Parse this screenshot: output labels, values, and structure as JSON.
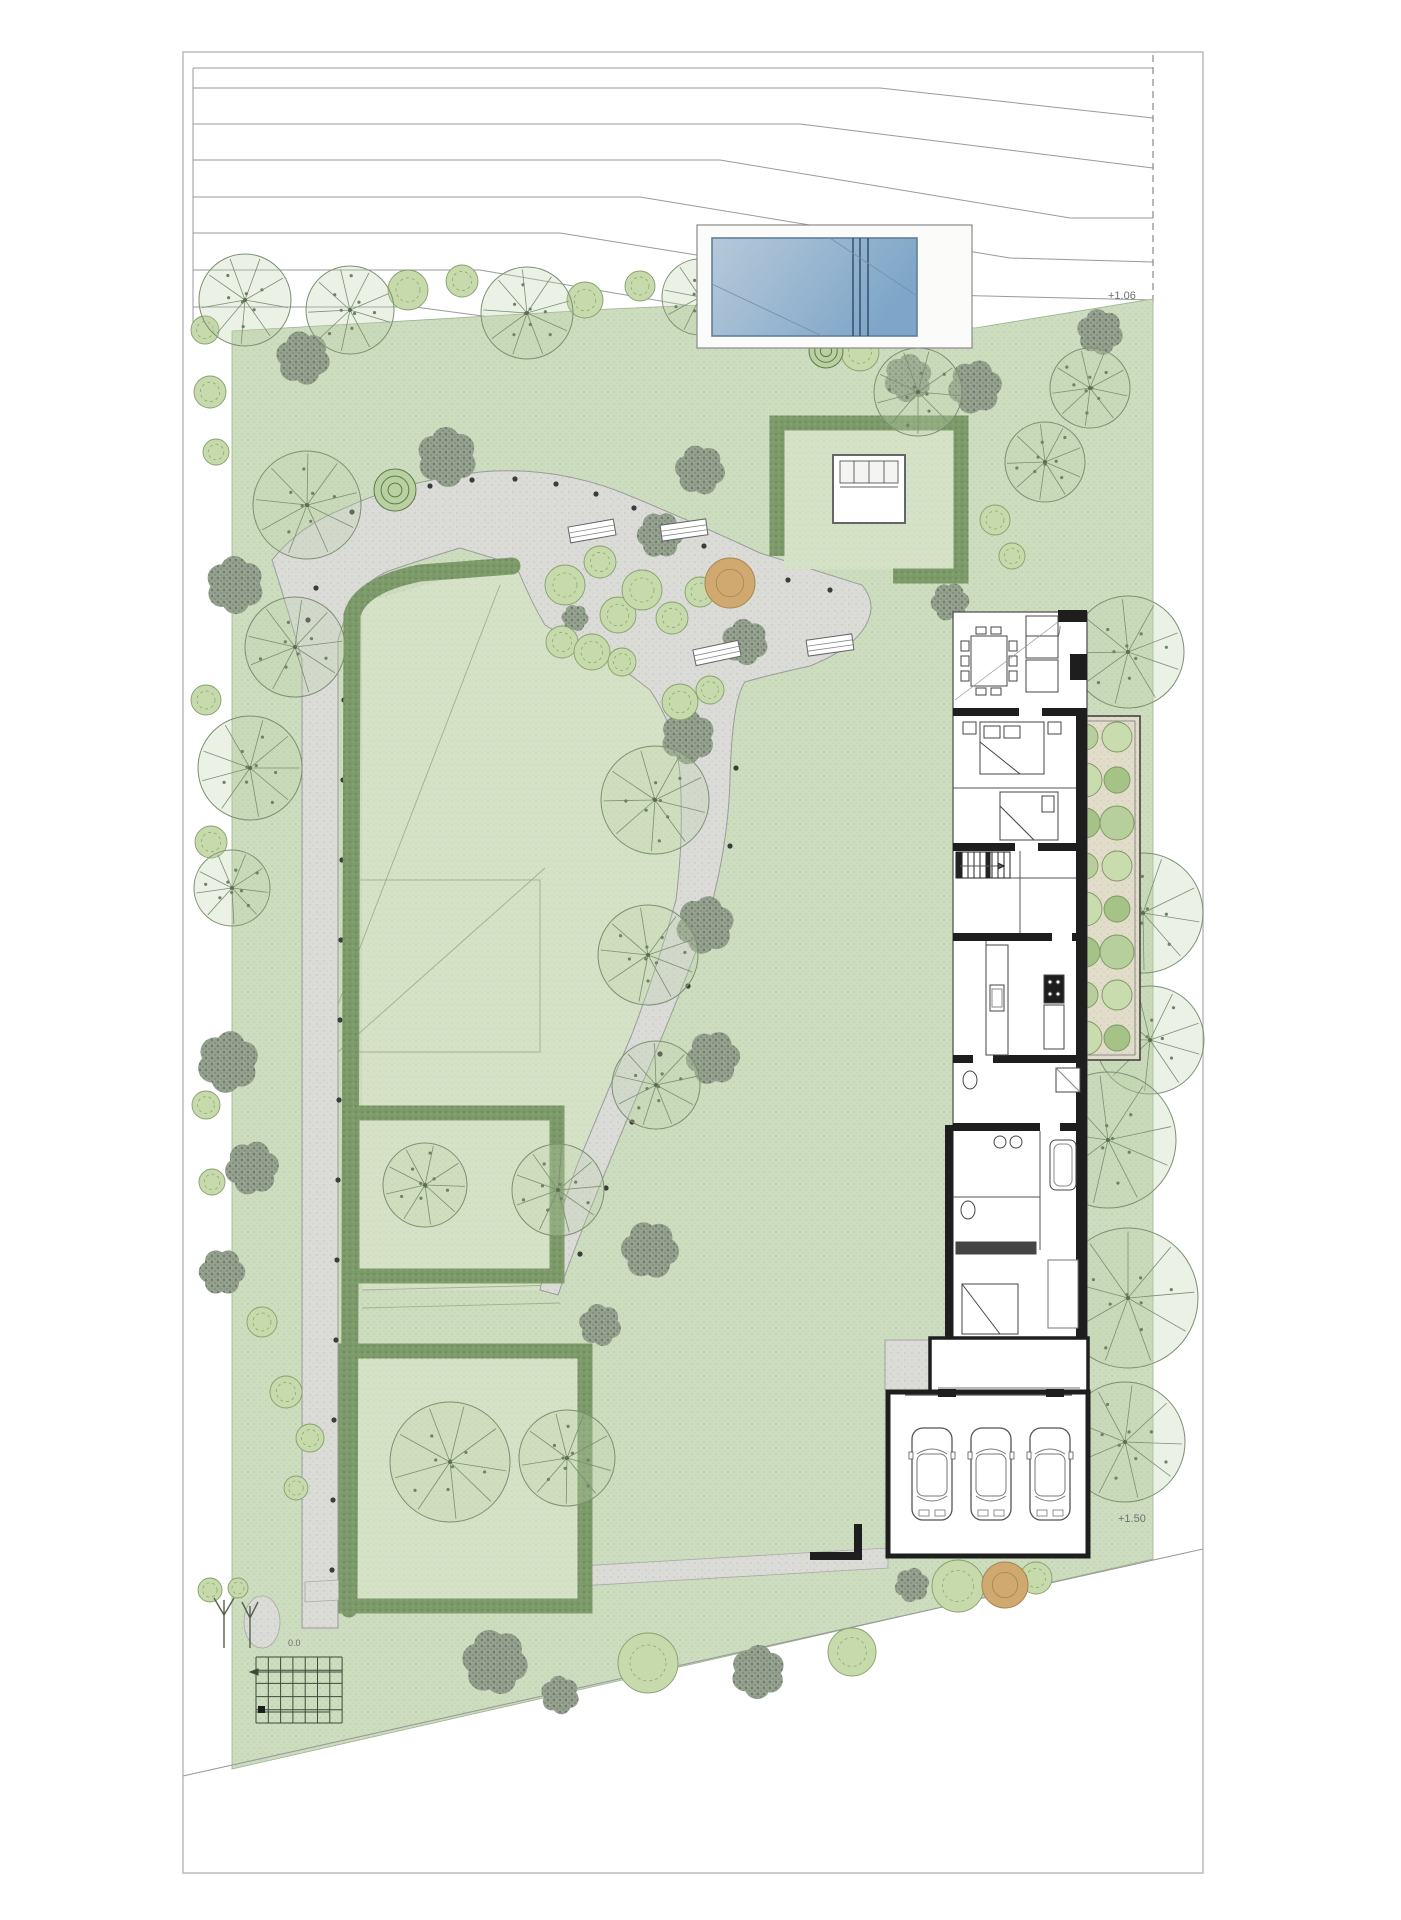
{
  "meta": {
    "drawing_type": "landscape-site-plan",
    "features": [
      "contour lines",
      "swimming pool",
      "garden pavilion",
      "hedge parterres",
      "winding gravel path",
      "residence floor plan",
      "planted strip",
      "garage with cars",
      "trellis grid"
    ]
  },
  "labels": {
    "elevation_upper": "+1.06",
    "elevation_lower": "+1.50",
    "path_end": "0.0"
  },
  "palette": {
    "paper": "#ffffff",
    "sheet_border": "#b7b7b7",
    "contour": "#9a9a9a",
    "green": "#cdddc0",
    "green_dot": "#bccdaa",
    "lawn": "#d6e2c7",
    "hedge": "#7d9a6a",
    "hedge_dark": "#4e6a3f",
    "path": "#dbdcd8",
    "path_edge": "#9b9b9b",
    "wall": "#1e1e1e",
    "line": "#555555",
    "pool_light": "#b6c9da",
    "pool_dark": "#7fa6c8",
    "pool_edge": "#5f7f9d",
    "gravel": "#e2ddca",
    "tan": "#cfa96f",
    "stipple": "#8f988b",
    "stipple_dark": "#6c7a66",
    "shrub_light": "#c6daab",
    "shrub_edge": "#87a06d",
    "text": "#6f6f6f"
  },
  "garage": {
    "car_count": 3,
    "cars_x": [
      912,
      971,
      1030
    ],
    "cars_y": 1428
  },
  "planter": {
    "x": 1066,
    "y": 716,
    "w": 74,
    "h": 344,
    "rows": 8,
    "cols_x": [
      1085,
      1117
    ]
  },
  "benches": [
    [
      592,
      531,
      -10
    ],
    [
      684,
      530,
      -8
    ],
    [
      717,
      653,
      -12
    ],
    [
      830,
      645,
      -8
    ]
  ],
  "trees": {
    "spoke": [
      [
        245,
        300,
        46
      ],
      [
        350,
        310,
        44
      ],
      [
        527,
        313,
        46
      ],
      [
        700,
        297,
        38
      ],
      [
        873,
        303,
        38
      ],
      [
        918,
        392,
        44
      ],
      [
        1090,
        388,
        40
      ],
      [
        1128,
        652,
        56
      ],
      [
        307,
        505,
        54
      ],
      [
        295,
        647,
        50
      ],
      [
        250,
        768,
        52
      ],
      [
        232,
        888,
        38
      ],
      [
        655,
        800,
        54
      ],
      [
        648,
        955,
        50
      ],
      [
        656,
        1085,
        44
      ],
      [
        558,
        1190,
        46
      ],
      [
        425,
        1185,
        42
      ],
      [
        1143,
        913,
        60
      ],
      [
        1150,
        1040,
        54
      ],
      [
        1108,
        1140,
        68
      ],
      [
        1128,
        1298,
        70
      ],
      [
        1125,
        1442,
        60
      ],
      [
        450,
        1462,
        60
      ],
      [
        567,
        1458,
        48
      ],
      [
        1045,
        462,
        40
      ]
    ],
    "stipple": [
      [
        303,
        358,
        28
      ],
      [
        447,
        457,
        31
      ],
      [
        908,
        378,
        25
      ],
      [
        975,
        387,
        28
      ],
      [
        660,
        535,
        24
      ],
      [
        700,
        470,
        26
      ],
      [
        745,
        642,
        24
      ],
      [
        688,
        737,
        28
      ],
      [
        705,
        925,
        30
      ],
      [
        713,
        1058,
        28
      ],
      [
        650,
        1250,
        30
      ],
      [
        600,
        1325,
        22
      ],
      [
        235,
        585,
        30
      ],
      [
        228,
        1062,
        32
      ],
      [
        252,
        1168,
        28
      ],
      [
        222,
        1272,
        24
      ],
      [
        495,
        1662,
        34
      ],
      [
        560,
        1695,
        20
      ],
      [
        758,
        1672,
        28
      ],
      [
        912,
        1585,
        18
      ],
      [
        950,
        602,
        20
      ],
      [
        575,
        618,
        14
      ],
      [
        1100,
        332,
        24
      ],
      [
        800,
        312,
        26
      ]
    ],
    "shrub": [
      [
        408,
        290,
        20
      ],
      [
        462,
        281,
        16
      ],
      [
        585,
        300,
        18
      ],
      [
        640,
        286,
        15
      ],
      [
        757,
        300,
        17
      ],
      [
        930,
        310,
        18
      ],
      [
        995,
        520,
        15
      ],
      [
        1012,
        556,
        13
      ],
      [
        565,
        585,
        20
      ],
      [
        600,
        562,
        16
      ],
      [
        618,
        615,
        18
      ],
      [
        642,
        590,
        20
      ],
      [
        672,
        618,
        16
      ],
      [
        700,
        592,
        15
      ],
      [
        562,
        642,
        16
      ],
      [
        592,
        652,
        18
      ],
      [
        622,
        662,
        14
      ],
      [
        680,
        702,
        18
      ],
      [
        710,
        690,
        14
      ],
      [
        205,
        330,
        14
      ],
      [
        210,
        392,
        16
      ],
      [
        216,
        452,
        13
      ],
      [
        206,
        700,
        15
      ],
      [
        211,
        842,
        16
      ],
      [
        206,
        1105,
        14
      ],
      [
        212,
        1182,
        13
      ],
      [
        262,
        1322,
        15
      ],
      [
        286,
        1392,
        16
      ],
      [
        648,
        1663,
        30
      ],
      [
        852,
        1652,
        24
      ],
      [
        958,
        1586,
        26
      ],
      [
        1036,
        1578,
        16
      ],
      [
        860,
        352,
        19
      ],
      [
        210,
        1590,
        12
      ],
      [
        238,
        1588,
        10
      ],
      [
        310,
        1438,
        14
      ],
      [
        296,
        1488,
        12
      ]
    ],
    "ring": [
      [
        395,
        490,
        21
      ],
      [
        826,
        351,
        17
      ]
    ],
    "tan": [
      [
        730,
        583,
        25
      ],
      [
        1005,
        1585,
        23
      ]
    ]
  },
  "path_dots": [
    [
      352,
      512
    ],
    [
      390,
      497
    ],
    [
      430,
      486
    ],
    [
      472,
      480
    ],
    [
      515,
      479
    ],
    [
      556,
      484
    ],
    [
      596,
      494
    ],
    [
      634,
      508
    ],
    [
      670,
      526
    ],
    [
      704,
      546
    ],
    [
      740,
      565
    ],
    [
      788,
      580
    ],
    [
      830,
      590
    ],
    [
      736,
      768
    ],
    [
      730,
      846
    ],
    [
      714,
      918
    ],
    [
      688,
      986
    ],
    [
      660,
      1054
    ],
    [
      632,
      1122
    ],
    [
      606,
      1188
    ],
    [
      580,
      1254
    ],
    [
      344,
      700
    ],
    [
      343,
      780
    ],
    [
      342,
      860
    ],
    [
      341,
      940
    ],
    [
      340,
      1020
    ],
    [
      339,
      1100
    ],
    [
      338,
      1180
    ],
    [
      337,
      1260
    ],
    [
      336,
      1340
    ],
    [
      334,
      1420
    ],
    [
      333,
      1500
    ],
    [
      332,
      1570
    ],
    [
      308,
      620
    ],
    [
      316,
      588
    ]
  ]
}
